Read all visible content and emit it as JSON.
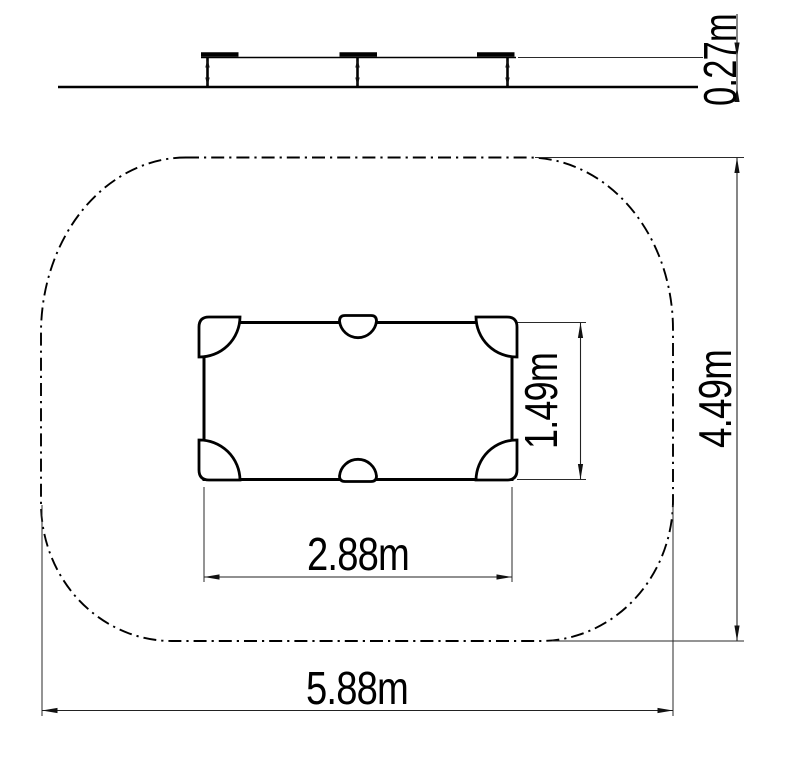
{
  "side_view": {
    "height_dimension": {
      "label": "0.27m",
      "value_m": 0.27
    }
  },
  "plan_view": {
    "item_width_dimension": {
      "label": "2.88m",
      "value_m": 2.88
    },
    "item_depth_dimension": {
      "label": "1.49m",
      "value_m": 1.49
    },
    "safety_zone_width_dimension": {
      "label": "5.88m",
      "value_m": 5.88
    },
    "safety_zone_depth_dimension": {
      "label": "4.49m",
      "value_m": 4.49
    }
  },
  "colors": {
    "outline": "#000000",
    "dimension_line": "#222222",
    "text": "#000000",
    "background": "#ffffff"
  }
}
